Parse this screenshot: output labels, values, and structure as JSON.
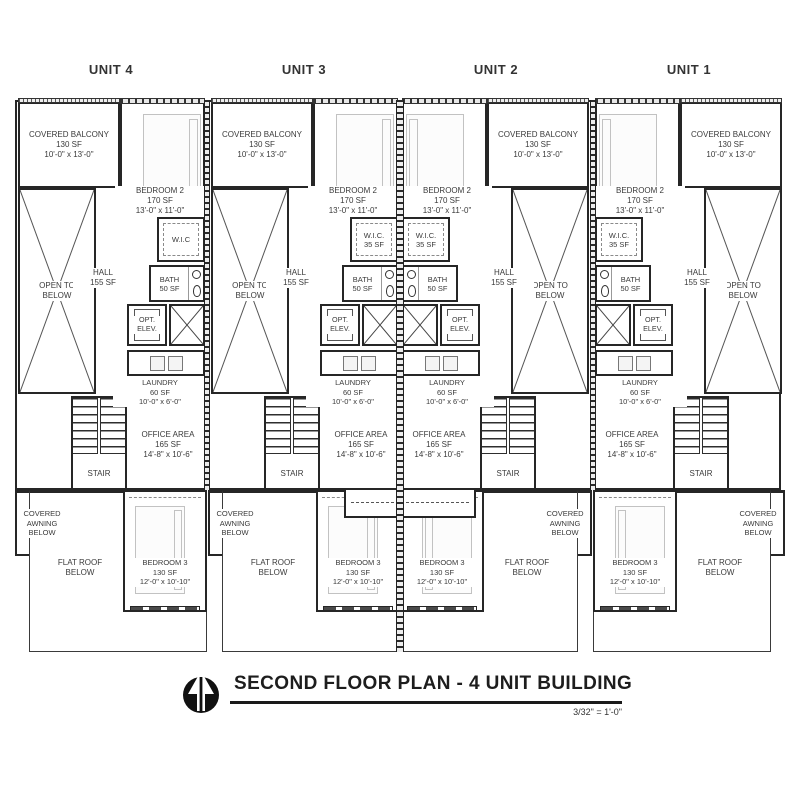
{
  "drawing": {
    "title": "SECOND FLOOR PLAN - 4 UNIT BUILDING",
    "scale": "3/32\" = 1'-0\"",
    "north_arrow": "north-arrow-icon"
  },
  "palette": {
    "wall": "#262626",
    "furniture": "#c2c2c2",
    "text": "#3a3a3a",
    "background": "#ffffff"
  },
  "units": [
    {
      "label": "UNIT 4",
      "balcony": {
        "name": "COVERED BALCONY",
        "area": "130 SF",
        "dims": "10'-0\" x 13'-0\""
      },
      "bedroom2": {
        "name": "BEDROOM 2",
        "area": "170 SF",
        "dims": "13'-0\" x 11'-0\""
      },
      "open_below": {
        "line1": "OPEN TO",
        "line2": "BELOW"
      },
      "wic": {
        "name": "W.I.C",
        "area": ""
      },
      "hall": {
        "name": "HALL",
        "area": "155 SF"
      },
      "bath": {
        "name": "BATH",
        "area": "50 SF"
      },
      "elev": {
        "line1": "OPT.",
        "line2": "ELEV."
      },
      "laundry": {
        "name": "LAUNDRY",
        "area": "60 SF",
        "dims": "10'-0\" x 6'-0\""
      },
      "stair": {
        "name": "STAIR"
      },
      "office": {
        "name": "OFFICE AREA",
        "area": "165 SF",
        "dims": "14'-8\" x 10'-6\""
      },
      "awning": {
        "line1": "COVERED",
        "line2": "AWNING",
        "line3": "BELOW"
      },
      "flat_roof": {
        "line1": "FLAT ROOF",
        "line2": "BELOW"
      },
      "bedroom3": {
        "name": "BEDROOM 3",
        "area": "130 SF",
        "dims": "12'-0\" x 10'-10\""
      }
    },
    {
      "label": "UNIT 3",
      "balcony": {
        "name": "COVERED BALCONY",
        "area": "130 SF",
        "dims": "10'-0\" x 13'-0\""
      },
      "bedroom2": {
        "name": "BEDROOM 2",
        "area": "170 SF",
        "dims": "13'-0\" x 11'-0\""
      },
      "open_below": {
        "line1": "OPEN TO",
        "line2": "BELOW"
      },
      "wic": {
        "name": "W.I.C.",
        "area": "35 SF"
      },
      "hall": {
        "name": "HALL",
        "area": "155 SF"
      },
      "bath": {
        "name": "BATH",
        "area": "50 SF"
      },
      "elev": {
        "line1": "OPT.",
        "line2": "ELEV."
      },
      "laundry": {
        "name": "LAUNDRY",
        "area": "60 SF",
        "dims": "10'-0\" x 6'-0\""
      },
      "stair": {
        "name": "STAIR"
      },
      "office": {
        "name": "OFFICE AREA",
        "area": "165 SF",
        "dims": "14'-8\" x 10'-6\""
      },
      "awning": {
        "line1": "COVERED",
        "line2": "AWNING",
        "line3": "BELOW"
      },
      "flat_roof": {
        "line1": "FLAT ROOF",
        "line2": "BELOW"
      },
      "bedroom3": {
        "name": "BEDROOM 3",
        "area": "130 SF",
        "dims": "12'-0\" x 10'-10\""
      }
    },
    {
      "label": "UNIT 2",
      "balcony": {
        "name": "COVERED BALCONY",
        "area": "130 SF",
        "dims": "10'-0\" x 13'-0\""
      },
      "bedroom2": {
        "name": "BEDROOM 2",
        "area": "170 SF",
        "dims": "13'-0\" x 11'-0\""
      },
      "open_below": {
        "line1": "OPEN TO",
        "line2": "BELOW"
      },
      "wic": {
        "name": "W.I.C.",
        "area": "35 SF"
      },
      "hall": {
        "name": "HALL",
        "area": "155 SF"
      },
      "bath": {
        "name": "BATH",
        "area": "50 SF"
      },
      "elev": {
        "line1": "OPT.",
        "line2": "ELEV."
      },
      "laundry": {
        "name": "LAUNDRY",
        "area": "60 SF",
        "dims": "10'-0\" x 6'-0\""
      },
      "stair": {
        "name": "STAIR"
      },
      "office": {
        "name": "OFFICE AREA",
        "area": "165 SF",
        "dims": "14'-8\" x 10'-6\""
      },
      "awning": {
        "line1": "COVERED",
        "line2": "AWNING",
        "line3": "BELOW"
      },
      "flat_roof": {
        "line1": "FLAT ROOF",
        "line2": "BELOW"
      },
      "bedroom3": {
        "name": "BEDROOM 3",
        "area": "130 SF",
        "dims": "12'-0\" x 10'-10\""
      }
    },
    {
      "label": "UNIT 1",
      "balcony": {
        "name": "COVERED BALCONY",
        "area": "130 SF",
        "dims": "10'-0\" x 13'-0\""
      },
      "bedroom2": {
        "name": "BEDROOM 2",
        "area": "170 SF",
        "dims": "13'-0\" x 11'-0\""
      },
      "open_below": {
        "line1": "OPEN TO",
        "line2": "BELOW"
      },
      "wic": {
        "name": "W.I.C.",
        "area": "35 SF"
      },
      "hall": {
        "name": "HALL",
        "area": "155 SF"
      },
      "bath": {
        "name": "BATH",
        "area": "50 SF"
      },
      "elev": {
        "line1": "OPT.",
        "line2": "ELEV."
      },
      "laundry": {
        "name": "LAUNDRY",
        "area": "60 SF",
        "dims": "10'-0\" x 6'-0\""
      },
      "stair": {
        "name": "STAIR"
      },
      "office": {
        "name": "OFFICE AREA",
        "area": "165 SF",
        "dims": "14'-8\" x 10'-6\""
      },
      "awning": {
        "line1": "COVERED",
        "line2": "AWNING",
        "line3": "BELOW"
      },
      "flat_roof": {
        "line1": "FLAT ROOF",
        "line2": "BELOW"
      },
      "bedroom3": {
        "name": "BEDROOM 3",
        "area": "130 SF",
        "dims": "12'-0\" x 10'-10\""
      }
    }
  ]
}
